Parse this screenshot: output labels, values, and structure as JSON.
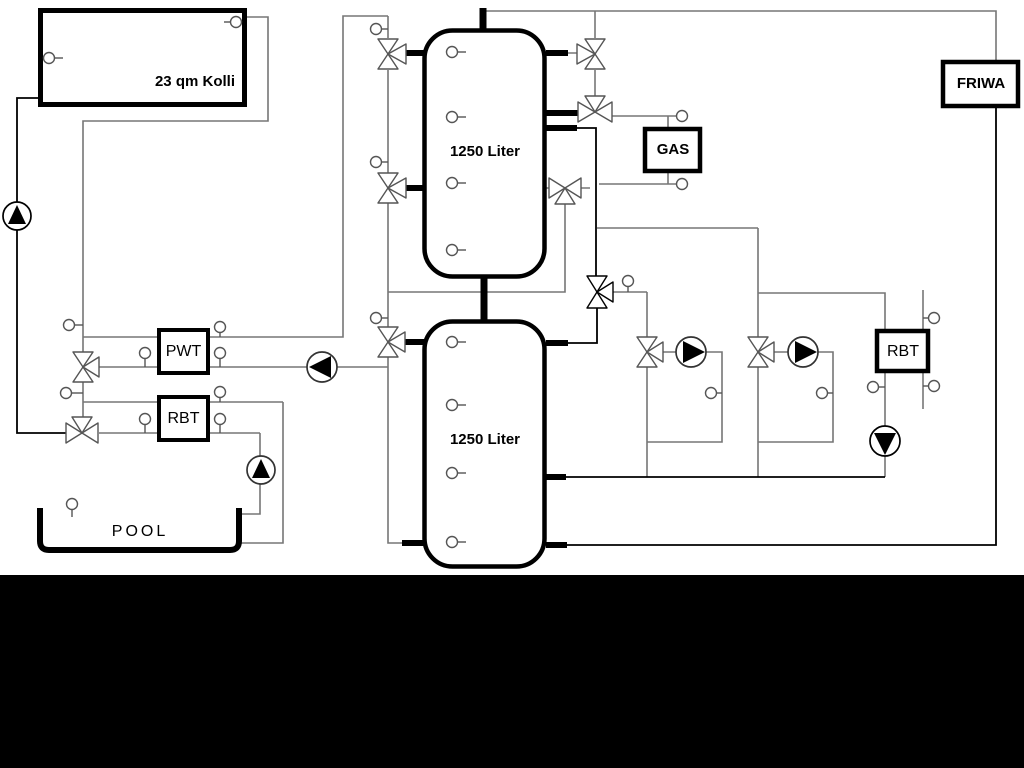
{
  "window": {
    "background": "#ffffff",
    "bottom_band_color": "#000000"
  },
  "labels": {
    "collector": "23 qm Kolli",
    "tank1": "1250 Liter",
    "tank2": "1250 Liter",
    "pwt": "PWT",
    "rbt_left": "RBT",
    "rbt_right": "RBT",
    "gas": "GAS",
    "friwa": "FRIWA",
    "pool": "POOL"
  },
  "colors": {
    "pipe_gray": "#767676",
    "pipe_black": "#000000",
    "symbol_stroke": "#555555",
    "box_border": "#000000",
    "pump_fill": "#000000"
  },
  "icons": {
    "pump": "circle-with-filled-triangle",
    "three_way_valve": "bowtie-triangles",
    "sensor": "small-circle-with-stem"
  }
}
